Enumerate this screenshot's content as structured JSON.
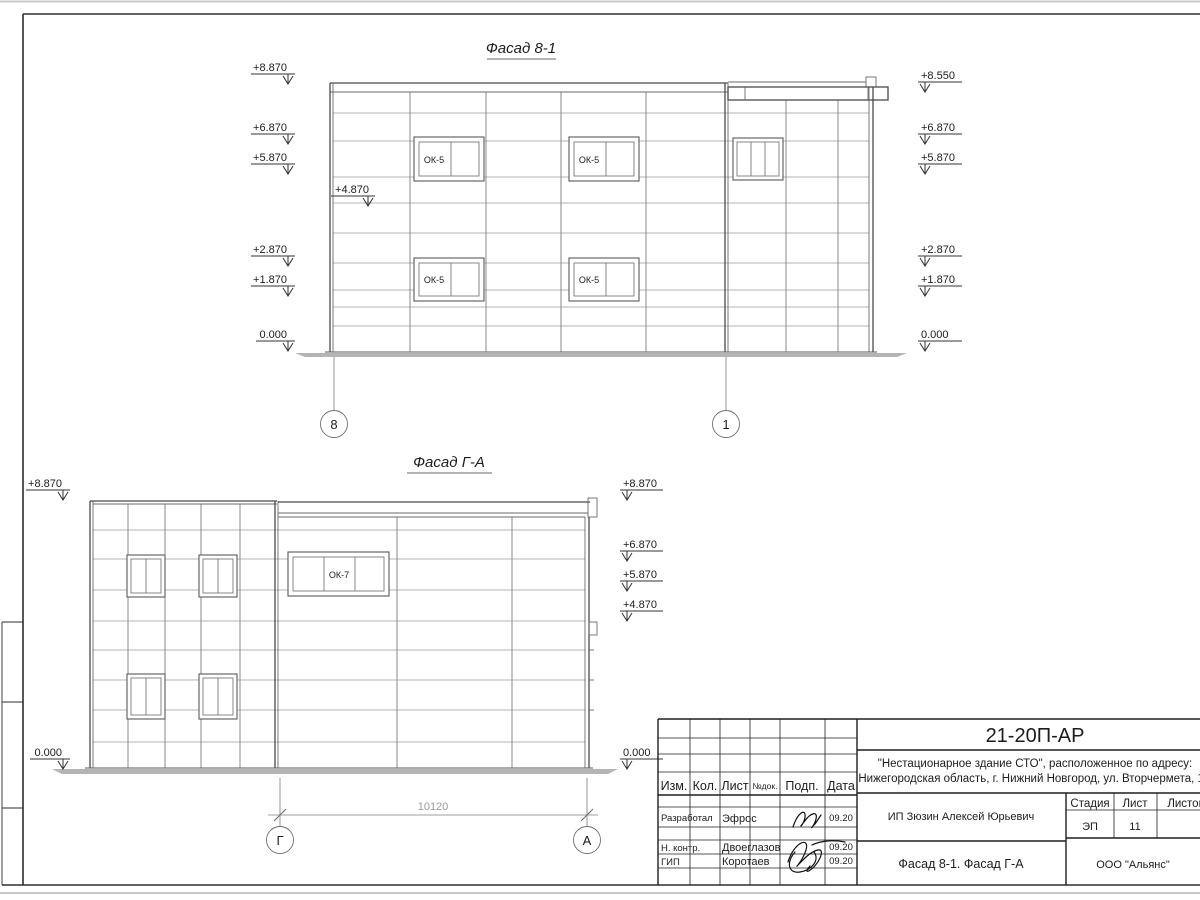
{
  "sheet": {
    "code": "21-20П-АР",
    "project_line1": "\"Нестационарное здание СТО\", расположенное по адресу:",
    "project_line2": "Нижегородская область, г. Нижний Новгород, ул. Вторчермета, 1А",
    "client": "ИП Зюзин Алексей Юрьевич",
    "sheet_title": "Фасад 8-1. Фасад Г-А",
    "company": "ООО \"Альянс\"",
    "stage_label": "Стадия",
    "sheet_label": "Лист",
    "sheets_label": "Листов",
    "stage": "ЭП",
    "sheet_no": "11"
  },
  "revision_header": {
    "izm": "Изм.",
    "kol": "Кол.",
    "list": "Лист",
    "ndok": "№док.",
    "podp": "Подп.",
    "data": "Дата"
  },
  "signoff": [
    {
      "role": "Разработал",
      "name": "Эфрос",
      "date": "09.20"
    },
    {
      "role": "Н. контр.",
      "name": "Двоеглазов",
      "date": "09.20"
    },
    {
      "role": "ГИП",
      "name": "Коротаев",
      "date": "09.20"
    }
  ],
  "facade1": {
    "title": "Фасад 8-1",
    "marks_left": [
      "+8.870",
      "+6.870",
      "+5.870",
      "+2.870",
      "+1.870",
      "0.000"
    ],
    "mark_inner": "+4.870",
    "marks_right": [
      "+8.550",
      "+6.870",
      "+5.870",
      "+2.870",
      "+1.870",
      "0.000"
    ],
    "window_label": "ОК-5",
    "grid_left": "8",
    "grid_right": "1"
  },
  "facade2": {
    "title": "Фасад Г-А",
    "marks_left": [
      "+8.870",
      "0.000"
    ],
    "marks_right": [
      "+8.870",
      "+6.870",
      "+5.870",
      "+4.870",
      "0.000"
    ],
    "window_label": "ОК-7",
    "grid_left": "Г",
    "grid_right": "А",
    "dimension": "10120"
  },
  "colors": {
    "drawing_line": "#4a4a4a",
    "panel_joint": "#9b9b9b",
    "ground": "#b4b4b4",
    "dim_text": "#9a9a9a"
  }
}
